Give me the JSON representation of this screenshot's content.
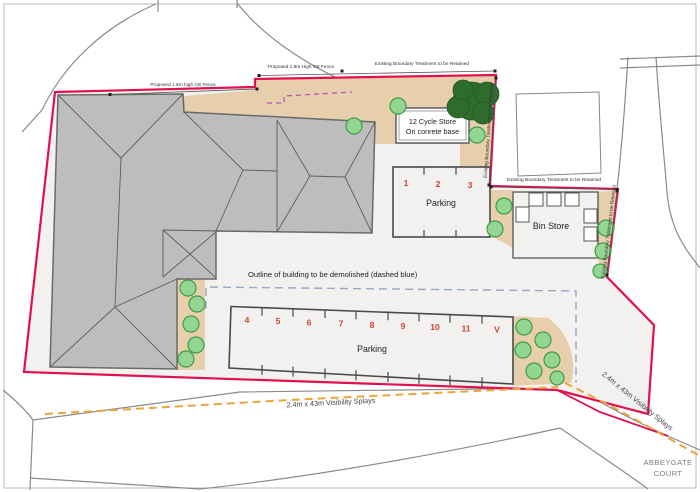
{
  "labels": {
    "fence_left": "Proposed 1.8m high CB Fence",
    "fence_right": "Proposed 1.8m High CB Fence",
    "boundary_retained": "Existing Boundary Treatment to be Retained",
    "demolish_note": "Outline of building to be demolished (dashed blue)",
    "visibility_splays": "2.4m x 43m Visibility Splays",
    "abbeygate_line1": "ABBEYGATE",
    "abbeygate_line2": "COURT"
  },
  "cycle_store": {
    "line1": "12 Cycle Store",
    "line2": "On conrete base"
  },
  "bin_store": {
    "label": "Bin Store"
  },
  "parking_upper": {
    "label": "Parking",
    "spaces": [
      "1",
      "2",
      "3"
    ]
  },
  "parking_lower": {
    "label": "Parking",
    "spaces": [
      "4",
      "5",
      "6",
      "7",
      "8",
      "9",
      "10",
      "11",
      "V"
    ]
  },
  "colors": {
    "boundary_red": "#e2104e",
    "landscape_tan": "#e7cfae",
    "tree_green": "#93d693",
    "tree_dark_green": "#2d6c2d",
    "roof_gray": "#bdbdbd",
    "splay_orange": "#eda43b",
    "demolish_blue": "#98a6c8",
    "fence_purple": "#b45ab4",
    "parking_number_red": "#cc4433"
  }
}
